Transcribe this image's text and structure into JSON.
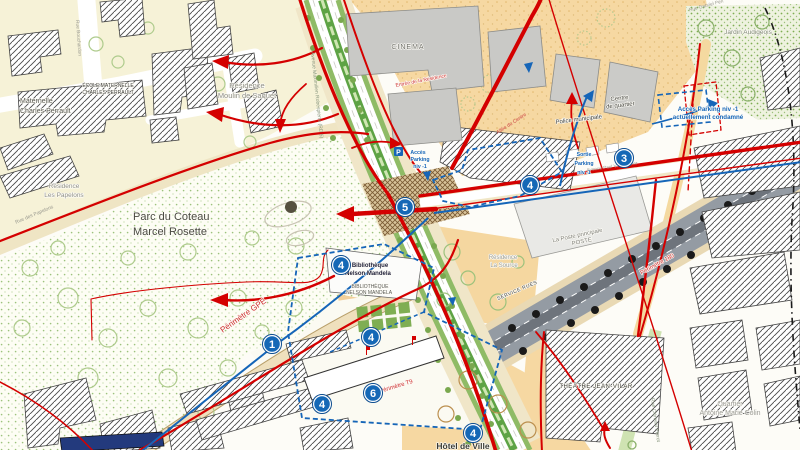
{
  "markers": {
    "m1": "1",
    "m3": "3",
    "m4a": "4",
    "m4b": "4",
    "m4c": "4",
    "m4d": "4",
    "m4e": "4",
    "m5": "5",
    "m6": "6"
  },
  "icons": {
    "parking_letter": "P"
  },
  "labels": {
    "ecole": [
      "ÉCOLE MATERNELLE",
      "CHARLES PERRAULT"
    ],
    "maternelle": [
      "Maternelle",
      "Charles Perrault"
    ],
    "residence_saquet": [
      "Résidence",
      "Moulin de Saquet"
    ],
    "residence_papelons": [
      "Résidence",
      "Les Papelons"
    ],
    "parc": [
      "Parc du Coteau",
      "Marcel Rosette"
    ],
    "cinema": "CINEMA",
    "jardin_audigeois": "Jardin Audigeois",
    "quartier_colin": [
      "Quartier",
      "Antoine Marie Colin"
    ],
    "theatre": "THÉÂTRE JEAN-VILAR",
    "hotel_de_ville": "Hôtel de Ville",
    "poste": [
      "La Poste principale",
      "POSTE"
    ],
    "bibliotheque": [
      "Bibliothèque",
      "Nelson Mandela"
    ],
    "bibliotheque_caps": [
      "BIBLIOTHÈQUE",
      "NELSON MANDELA"
    ],
    "police": "Police municipale",
    "centre_quartier": [
      "Centre",
      "de quartier"
    ],
    "residence_source": [
      "Résidence",
      "La Source"
    ],
    "acces_parking_condamne": [
      "Accès Parking niv -1",
      "actuellement condamné"
    ],
    "acces_parking": [
      "Accès",
      "Parking",
      "niv -1"
    ],
    "sortie_parking": [
      "Sortie",
      "Parking",
      "niv -1"
    ],
    "perimetre_gpe": "Périmètre GPE",
    "perimetre_t9": "Périmètre T9",
    "perimetre_180": "Périmètre 180",
    "service_rues": "SERVICE RUES",
    "entree_residence": "Entrée de la Résidence",
    "av_robespierre": "Avenue Maximilien Robespierre (RD 5)",
    "avenue_est": "Avenue Paul V. Couturier",
    "rue_clement_perrot": "Rue Clément Perrot",
    "rue_papelons": "Rue des Papelons",
    "rue_bouchardon": "Rue Bouchardon",
    "allee_centre": "Allée du Centre",
    "rue_gabriel_peri": "Rue Gabriel Péri"
  },
  "colors": {
    "accent_red": "#d40000",
    "route_blue": "#1565b8",
    "marker_blue": "#1568b6",
    "cream_zone": "#f6f2d7",
    "orange_zone": "#f6d8a2",
    "park_dot_green": "#9cc27c",
    "tram_median_green": "#5ea345",
    "gray_building": "#c9c9c6",
    "avenue_gray": "#949ba3"
  }
}
